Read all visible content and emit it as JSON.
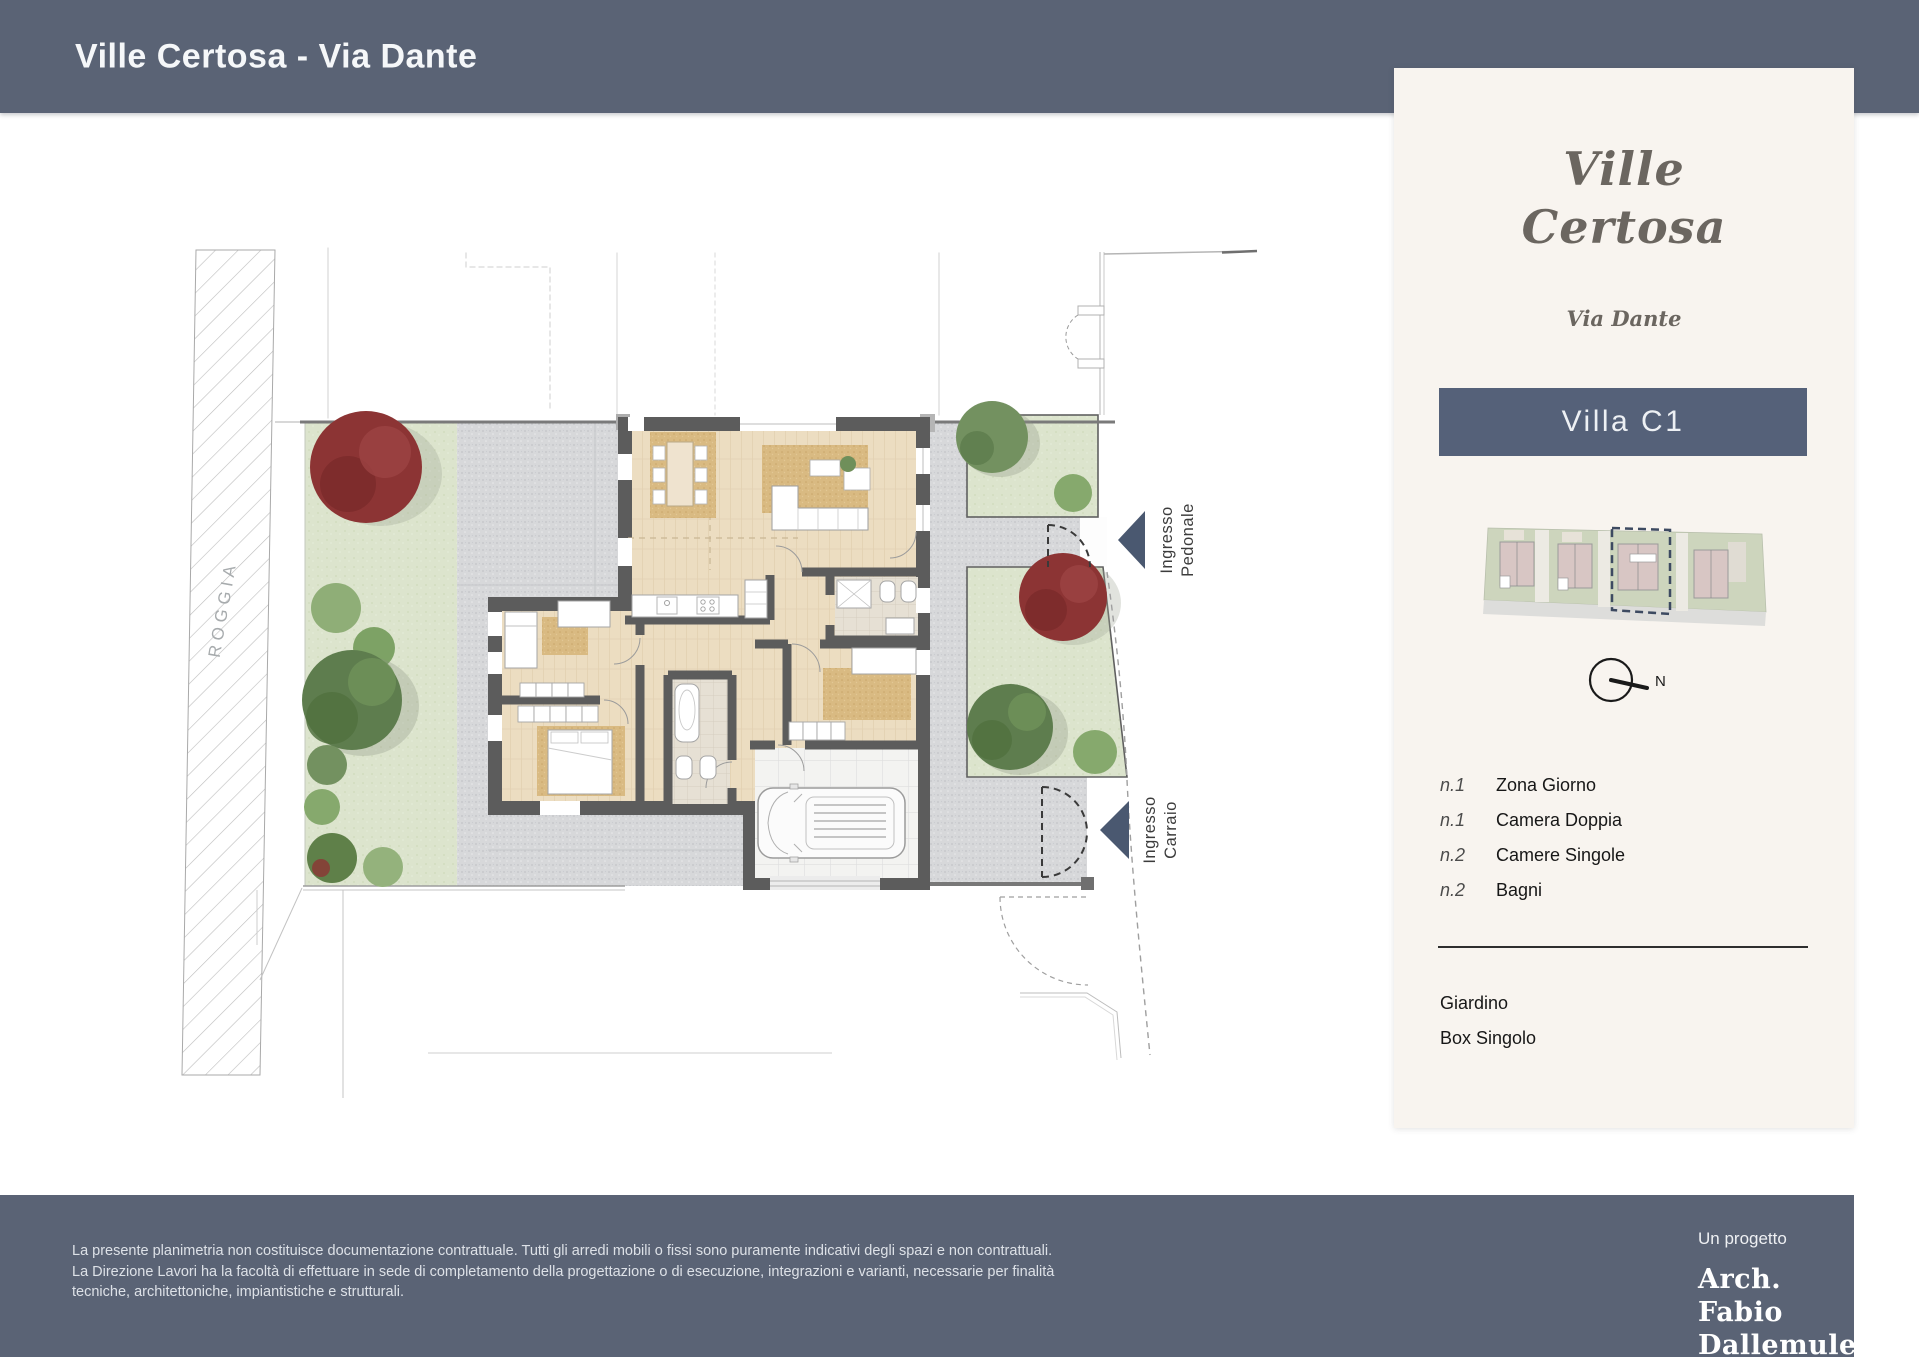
{
  "header": {
    "title": "Ville Certosa - Via Dante"
  },
  "sidebar": {
    "logo_line1": "Ville",
    "logo_line2": "Certosa",
    "logo_sub": "Via Dante",
    "unit_banner": "Villa C1",
    "compass_label": "N",
    "rooms": [
      {
        "qty": "n.1",
        "label": "Zona Giorno"
      },
      {
        "qty": "n.1",
        "label": "Camera Doppia"
      },
      {
        "qty": "n.2",
        "label": "Camere Singole"
      },
      {
        "qty": "n.2",
        "label": "Bagni"
      }
    ],
    "extras": [
      "Giardino",
      "Box Singolo"
    ]
  },
  "plan": {
    "canal_label": "ROGGIA",
    "entrance_pedestrian": [
      "Ingresso",
      "Pedonale"
    ],
    "entrance_driveway": [
      "Ingresso",
      "Carraio"
    ]
  },
  "footer": {
    "disclaimer": "La presente planimetria non costituisce documentazione contrattuale. Tutti gli arredi mobili o fissi sono puramente indicativi degli spazi e non contrattuali. La Direzione Lavori ha la  facoltà di effettuare in sede di completamento della progettazione o di esecuzione, integrazioni e varianti, necessarie per finalità tecniche, architettoniche, impiantistiche e strutturali.",
    "project_by": "Un progetto",
    "architect_line1": "Arch. Fabio",
    "architect_line2": "Dallemule"
  },
  "colors": {
    "header_bar": "#5a6375",
    "panel_bg": "#f8f4ef",
    "banner_bg": "#556179",
    "arrow": "#4a5870",
    "lawn": "#dce4cd",
    "gravel": "#d7d8da",
    "wood_floor": "#ecddc1",
    "wall": "#5c5c5c",
    "tree_green": "#739160",
    "tree_red": "#8c3434",
    "logo_text": "#6b6660"
  }
}
